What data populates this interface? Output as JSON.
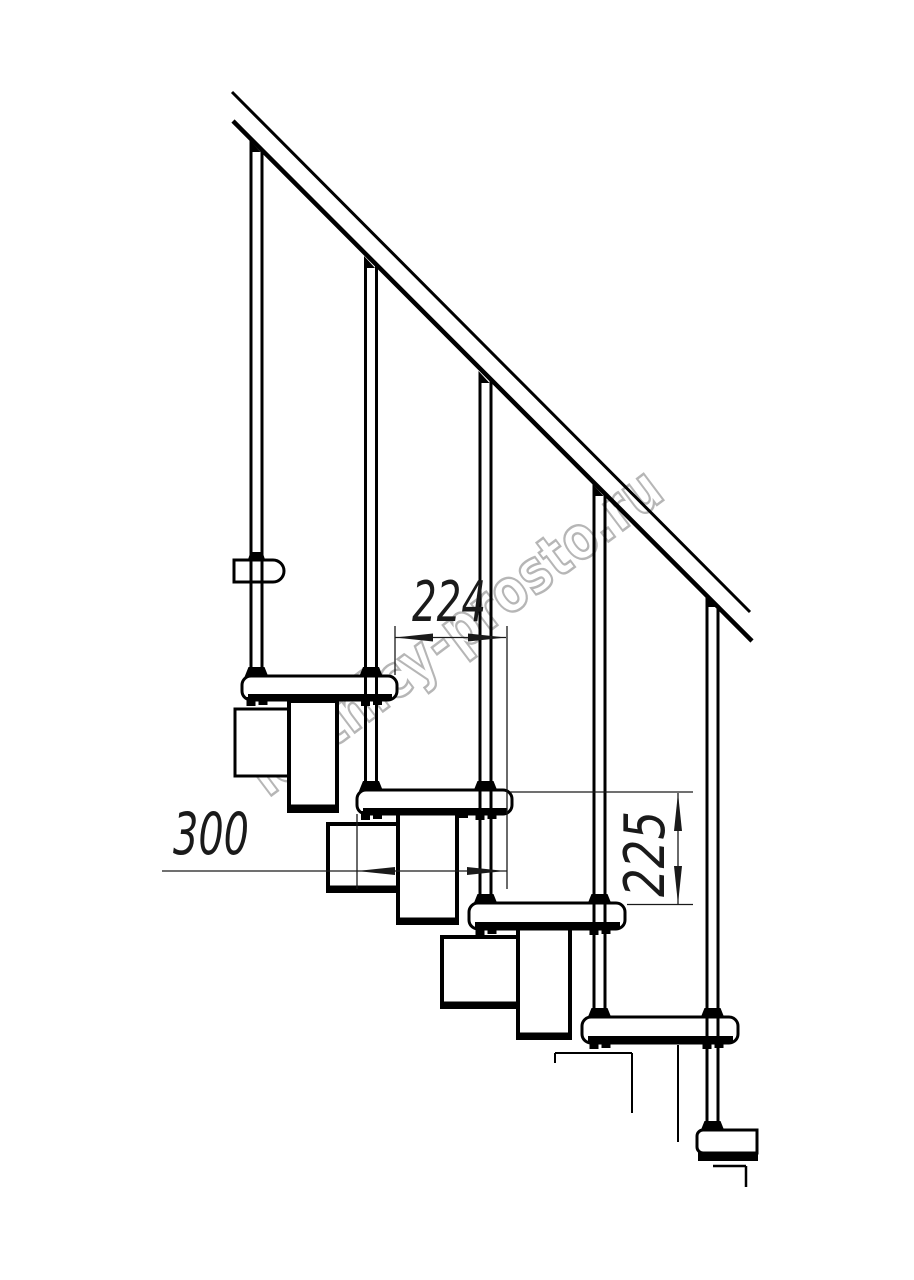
{
  "drawing": {
    "watermark": {
      "text": "lestnicy-prosto.ru"
    },
    "dimensions": {
      "run": {
        "value": "224"
      },
      "depth": {
        "value": "300"
      },
      "rise": {
        "value": "225"
      }
    },
    "colors": {
      "line": "#000000",
      "dimension": "#1a1a1a",
      "watermark": "#b6b6b6",
      "background": "#ffffff"
    }
  }
}
